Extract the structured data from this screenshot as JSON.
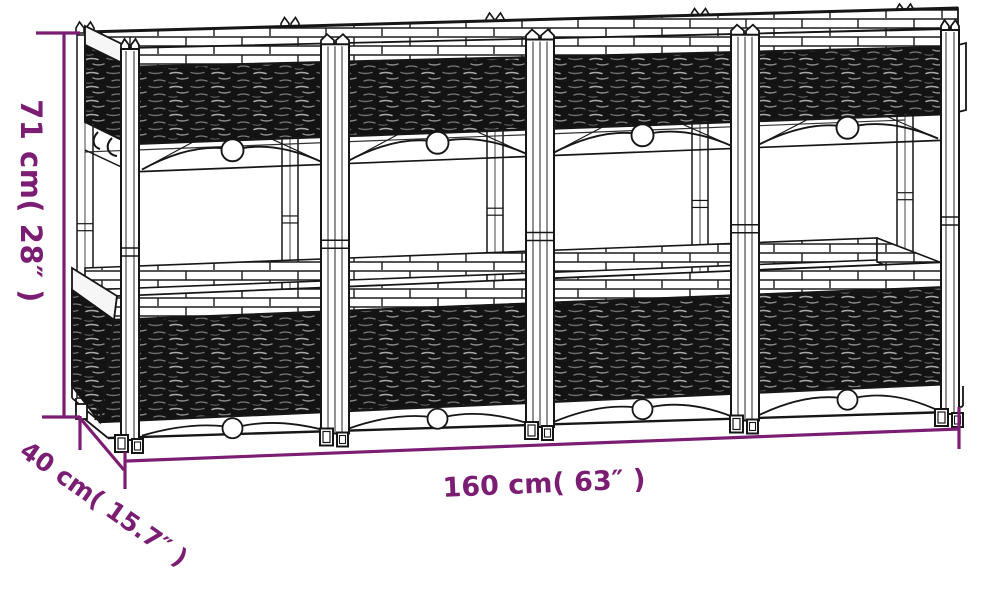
{
  "diagram": {
    "illustration": {
      "name": "raised-garden-bed-planter-line-art",
      "bays": 4
    },
    "colors": {
      "dimension_accent": "#7c1d74",
      "line_art": "#161616",
      "background": "#ffffff"
    },
    "dimensions": {
      "height": {
        "label": "71 cm( 28″ )"
      },
      "depth": {
        "label": "40 cm( 15.7″ )"
      },
      "width": {
        "label": "160 cm( 63″ )"
      }
    }
  }
}
